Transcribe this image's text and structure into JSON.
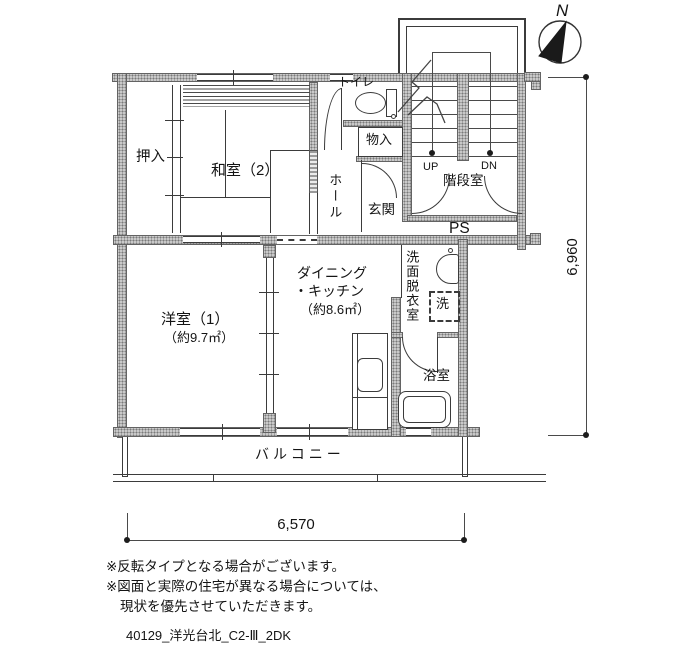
{
  "compass": {
    "north": "N"
  },
  "rooms": {
    "oshiire": "押入",
    "washitsu2": "和室（2）",
    "toilet": "トイレ",
    "monoire": "物入",
    "hall": "ホール",
    "genkan": "玄関",
    "kaidanshitsu": "階段室",
    "up": "UP",
    "dn": "DN",
    "ps": "PS",
    "dk_line1": "ダイニング",
    "dk_line2": "・キッチン",
    "dk_area": "（約8.6㎡）",
    "senmen": "洗面脱衣室",
    "laundry": "洗",
    "bath": "浴室",
    "yoshitsu1": "洋室（1）",
    "yoshitsu1_area": "（約9.7㎡）",
    "balcony": "バルコニー"
  },
  "dimensions": {
    "width": "6,570",
    "height": "6,960"
  },
  "notes": [
    "※反転タイプとなる場合がございます。",
    "※図面と実際の住宅が異なる場合については、",
    "現状を優先させていただきます。"
  ],
  "plan_id": "40129_洋光台北_C2-Ⅲ_2DK",
  "colors": {
    "wall_fill": "#c9c9c9",
    "line": "#3b3b3b",
    "background": "#ffffff"
  }
}
